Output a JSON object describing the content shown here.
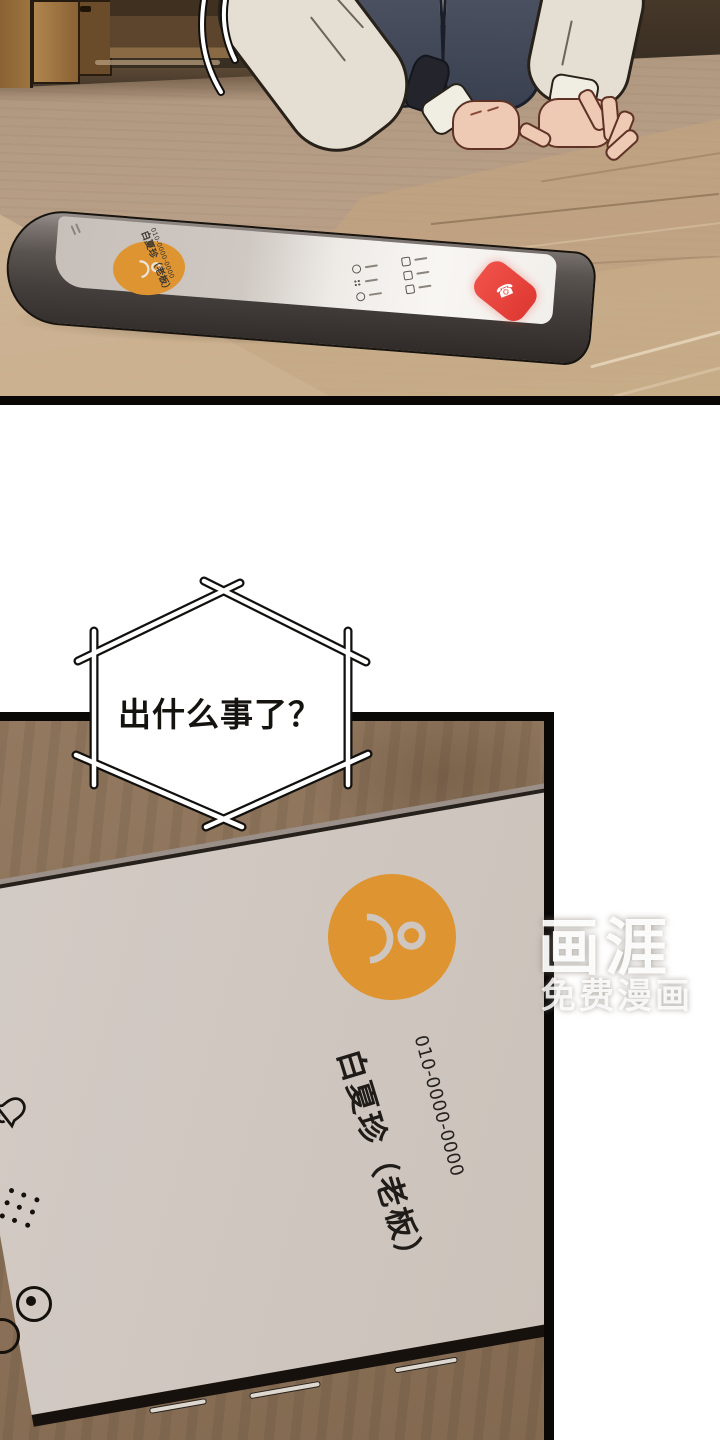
{
  "comic": {
    "bubble": {
      "text": "出什么事了？"
    },
    "contact": {
      "name": "白夏珍（老板）",
      "number": "010-0000-0000"
    },
    "watermark": {
      "title": "画涯",
      "subtitle": "免费漫画"
    },
    "phone_call_ui": {
      "end_call_glyph": "☎",
      "icons": [
        "mute-bell-icon",
        "dial-pad-icon",
        "record-icon",
        "person-avatar-icon",
        "end-call-icon"
      ]
    },
    "colors": {
      "accent_orange": "#de9531",
      "end_call_red": "#e8433c",
      "screen_gray": "#cfc6bf",
      "wood_brown": "#8c735a",
      "floor_tan": "#b59c84",
      "panel_border": "#0a0807",
      "bubble_fill": "#ffffff",
      "ink": "#151310"
    }
  }
}
